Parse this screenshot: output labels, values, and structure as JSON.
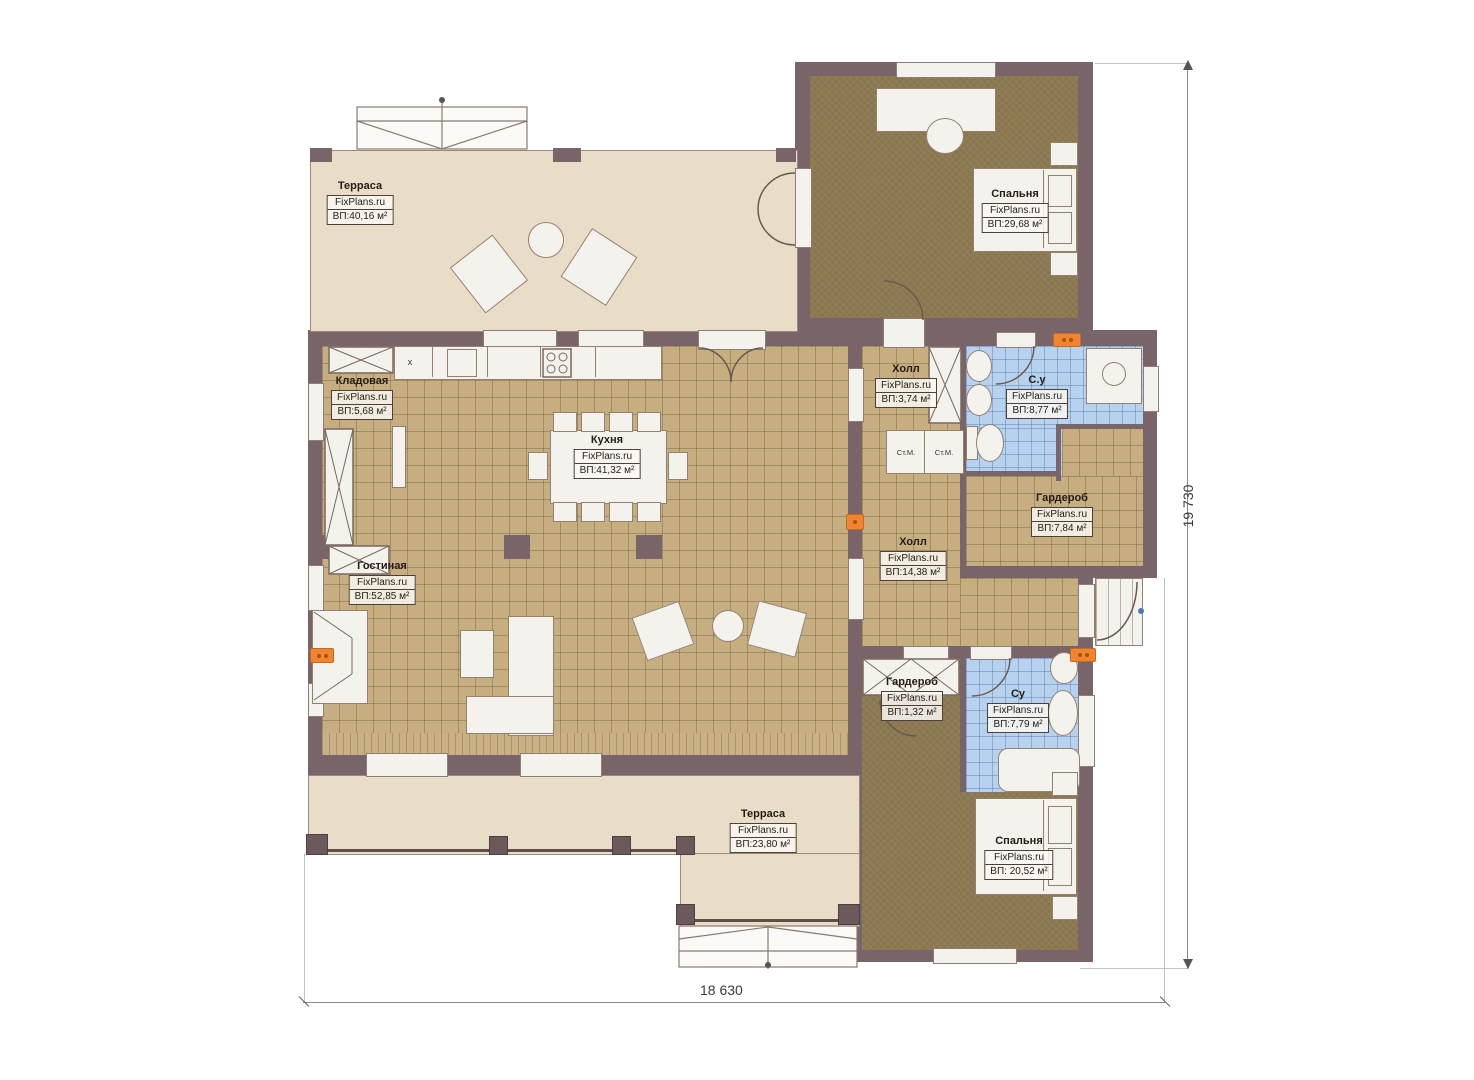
{
  "site": "FixPlans.ru",
  "rooms": {
    "terrace_top": {
      "name": "Терраса",
      "brand": "FixPlans.ru",
      "area": "ВП:40,16 м²"
    },
    "bedroom_top": {
      "name": "Спальня",
      "brand": "FixPlans.ru",
      "area": "ВП:29,68 м²"
    },
    "pantry": {
      "name": "Кладовая",
      "brand": "FixPlans.ru",
      "area": "ВП:5,68 м²"
    },
    "kitchen": {
      "name": "Кухня",
      "brand": "FixPlans.ru",
      "area": "ВП:41,32 м²"
    },
    "hall_small": {
      "name": "Холл",
      "brand": "FixPlans.ru",
      "area": "ВП:3,74 м²"
    },
    "bathroom_top": {
      "name": "С.у",
      "brand": "FixPlans.ru",
      "area": "ВП:8,77 м²"
    },
    "wardrobe_top": {
      "name": "Гардероб",
      "brand": "FixPlans.ru",
      "area": "ВП:7,84 м²"
    },
    "hall_main": {
      "name": "Холл",
      "brand": "FixPlans.ru",
      "area": "ВП:14,38 м²"
    },
    "living": {
      "name": "Гостиная",
      "brand": "FixPlans.ru",
      "area": "ВП:52,85 м²"
    },
    "wardrobe_small": {
      "name": "Гардероб",
      "brand": "FixPlans.ru",
      "area": "ВП:1,32 м²"
    },
    "bathroom_bottom": {
      "name": "Су",
      "brand": "FixPlans.ru",
      "area": "ВП:7,79 м²"
    },
    "bedroom_bottom": {
      "name": "Спальня",
      "brand": "FixPlans.ru",
      "area": "ВП: 20,52 м²"
    },
    "terrace_bottom": {
      "name": "Терраса",
      "brand": "FixPlans.ru",
      "area": "ВП:23,80 м²"
    }
  },
  "fixtures": {
    "washer_label": "Ст.М.",
    "cabinet_x_label": "x"
  },
  "dimensions": {
    "width": "18 630",
    "height": "19 730"
  },
  "colors": {
    "wall": "#796569",
    "floor_tile": "#c6ae80",
    "floor_wood": "#8d7a52",
    "floor_bath": "#b7d2ee",
    "terrace": "#e9ddc8",
    "radiator": "#f08430"
  }
}
